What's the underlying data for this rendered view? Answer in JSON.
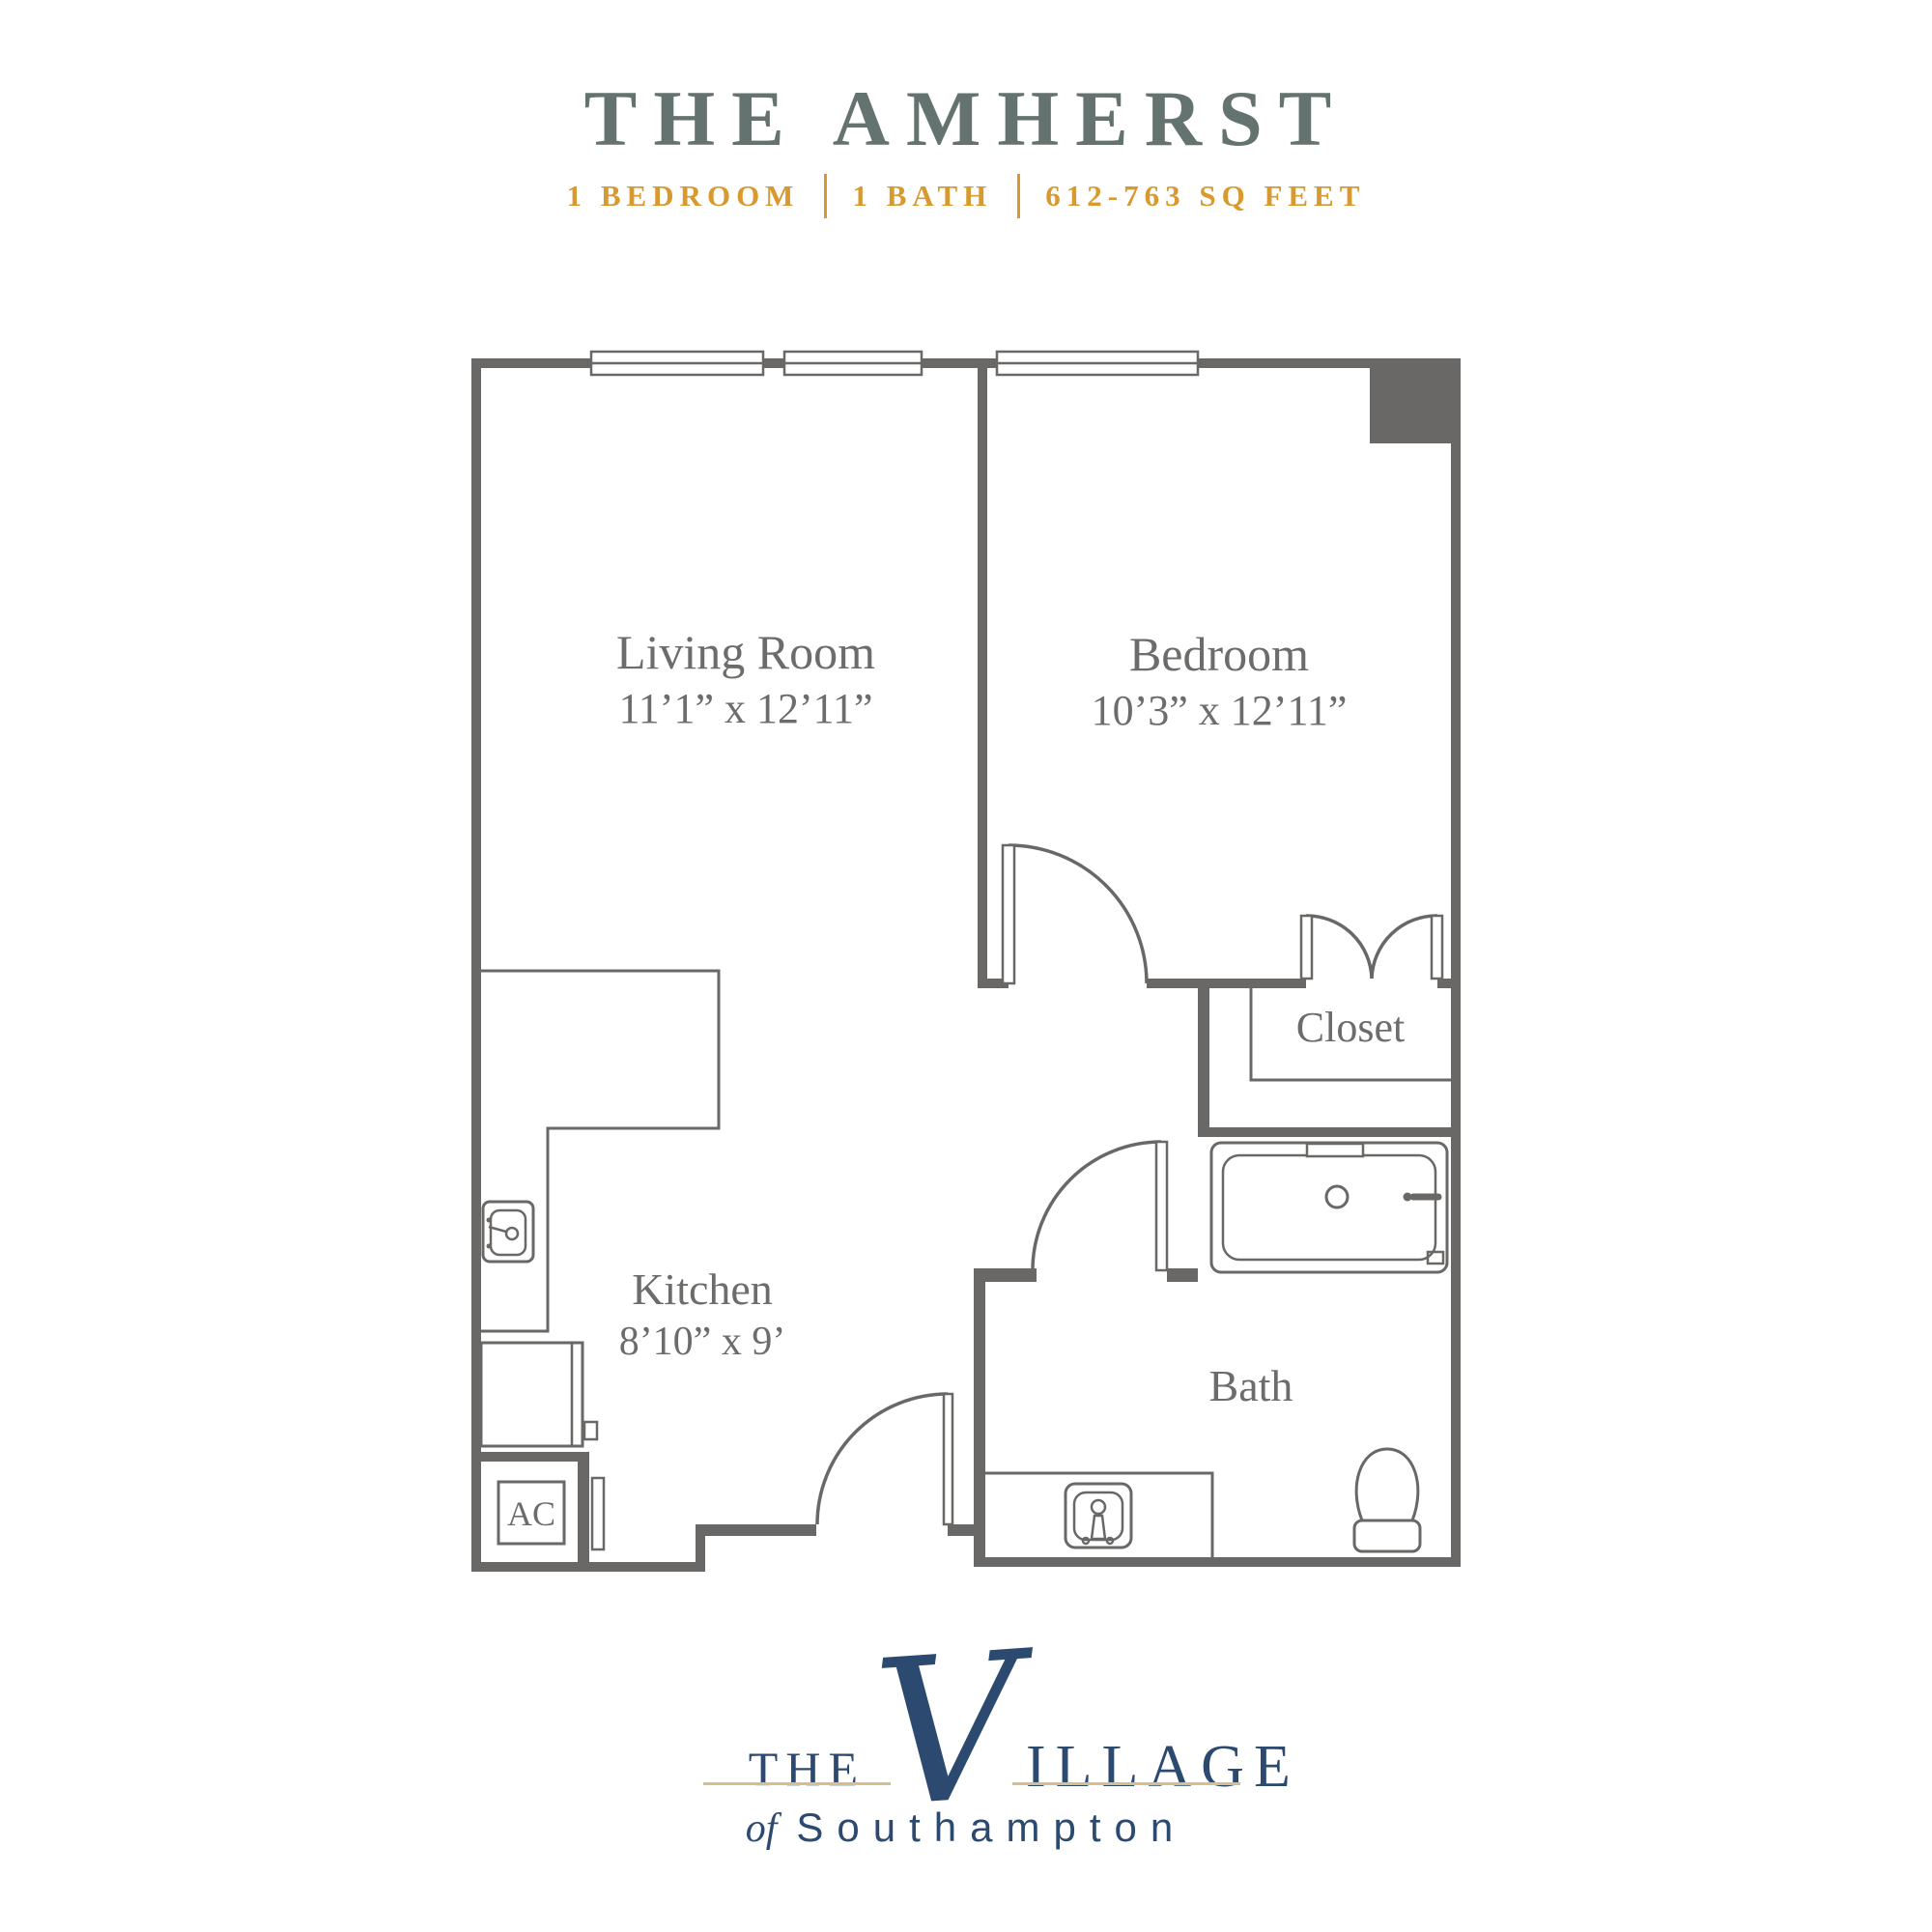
{
  "header": {
    "title": "THE AMHERST",
    "spec_bedroom": "1 BEDROOM",
    "spec_bath": "1 BATH",
    "spec_sqft": "612-763 SQ FEET"
  },
  "floorplan": {
    "living_room": {
      "name": "Living Room",
      "dims": "11’1” x 12’11”"
    },
    "bedroom": {
      "name": "Bedroom",
      "dims": "10’3” x 12’11”"
    },
    "kitchen": {
      "name": "Kitchen",
      "dims": "8’10” x 9’"
    },
    "bath": {
      "name": "Bath"
    },
    "closet": {
      "name": "Closet"
    },
    "ac_unit": {
      "label": "AC"
    }
  },
  "logo": {
    "word_the": "THE",
    "word_v": "V",
    "word_illage": "ILLAGE",
    "tagline_of": "of",
    "tagline_place": "Southampton"
  },
  "colors": {
    "title_green": "#64736F",
    "accent_gold": "#D8992E",
    "wall_gray": "#6A6866",
    "label_gray": "#6E6C6A",
    "logo_navy": "#2C4A70",
    "logo_gold": "#D5BF8A"
  }
}
